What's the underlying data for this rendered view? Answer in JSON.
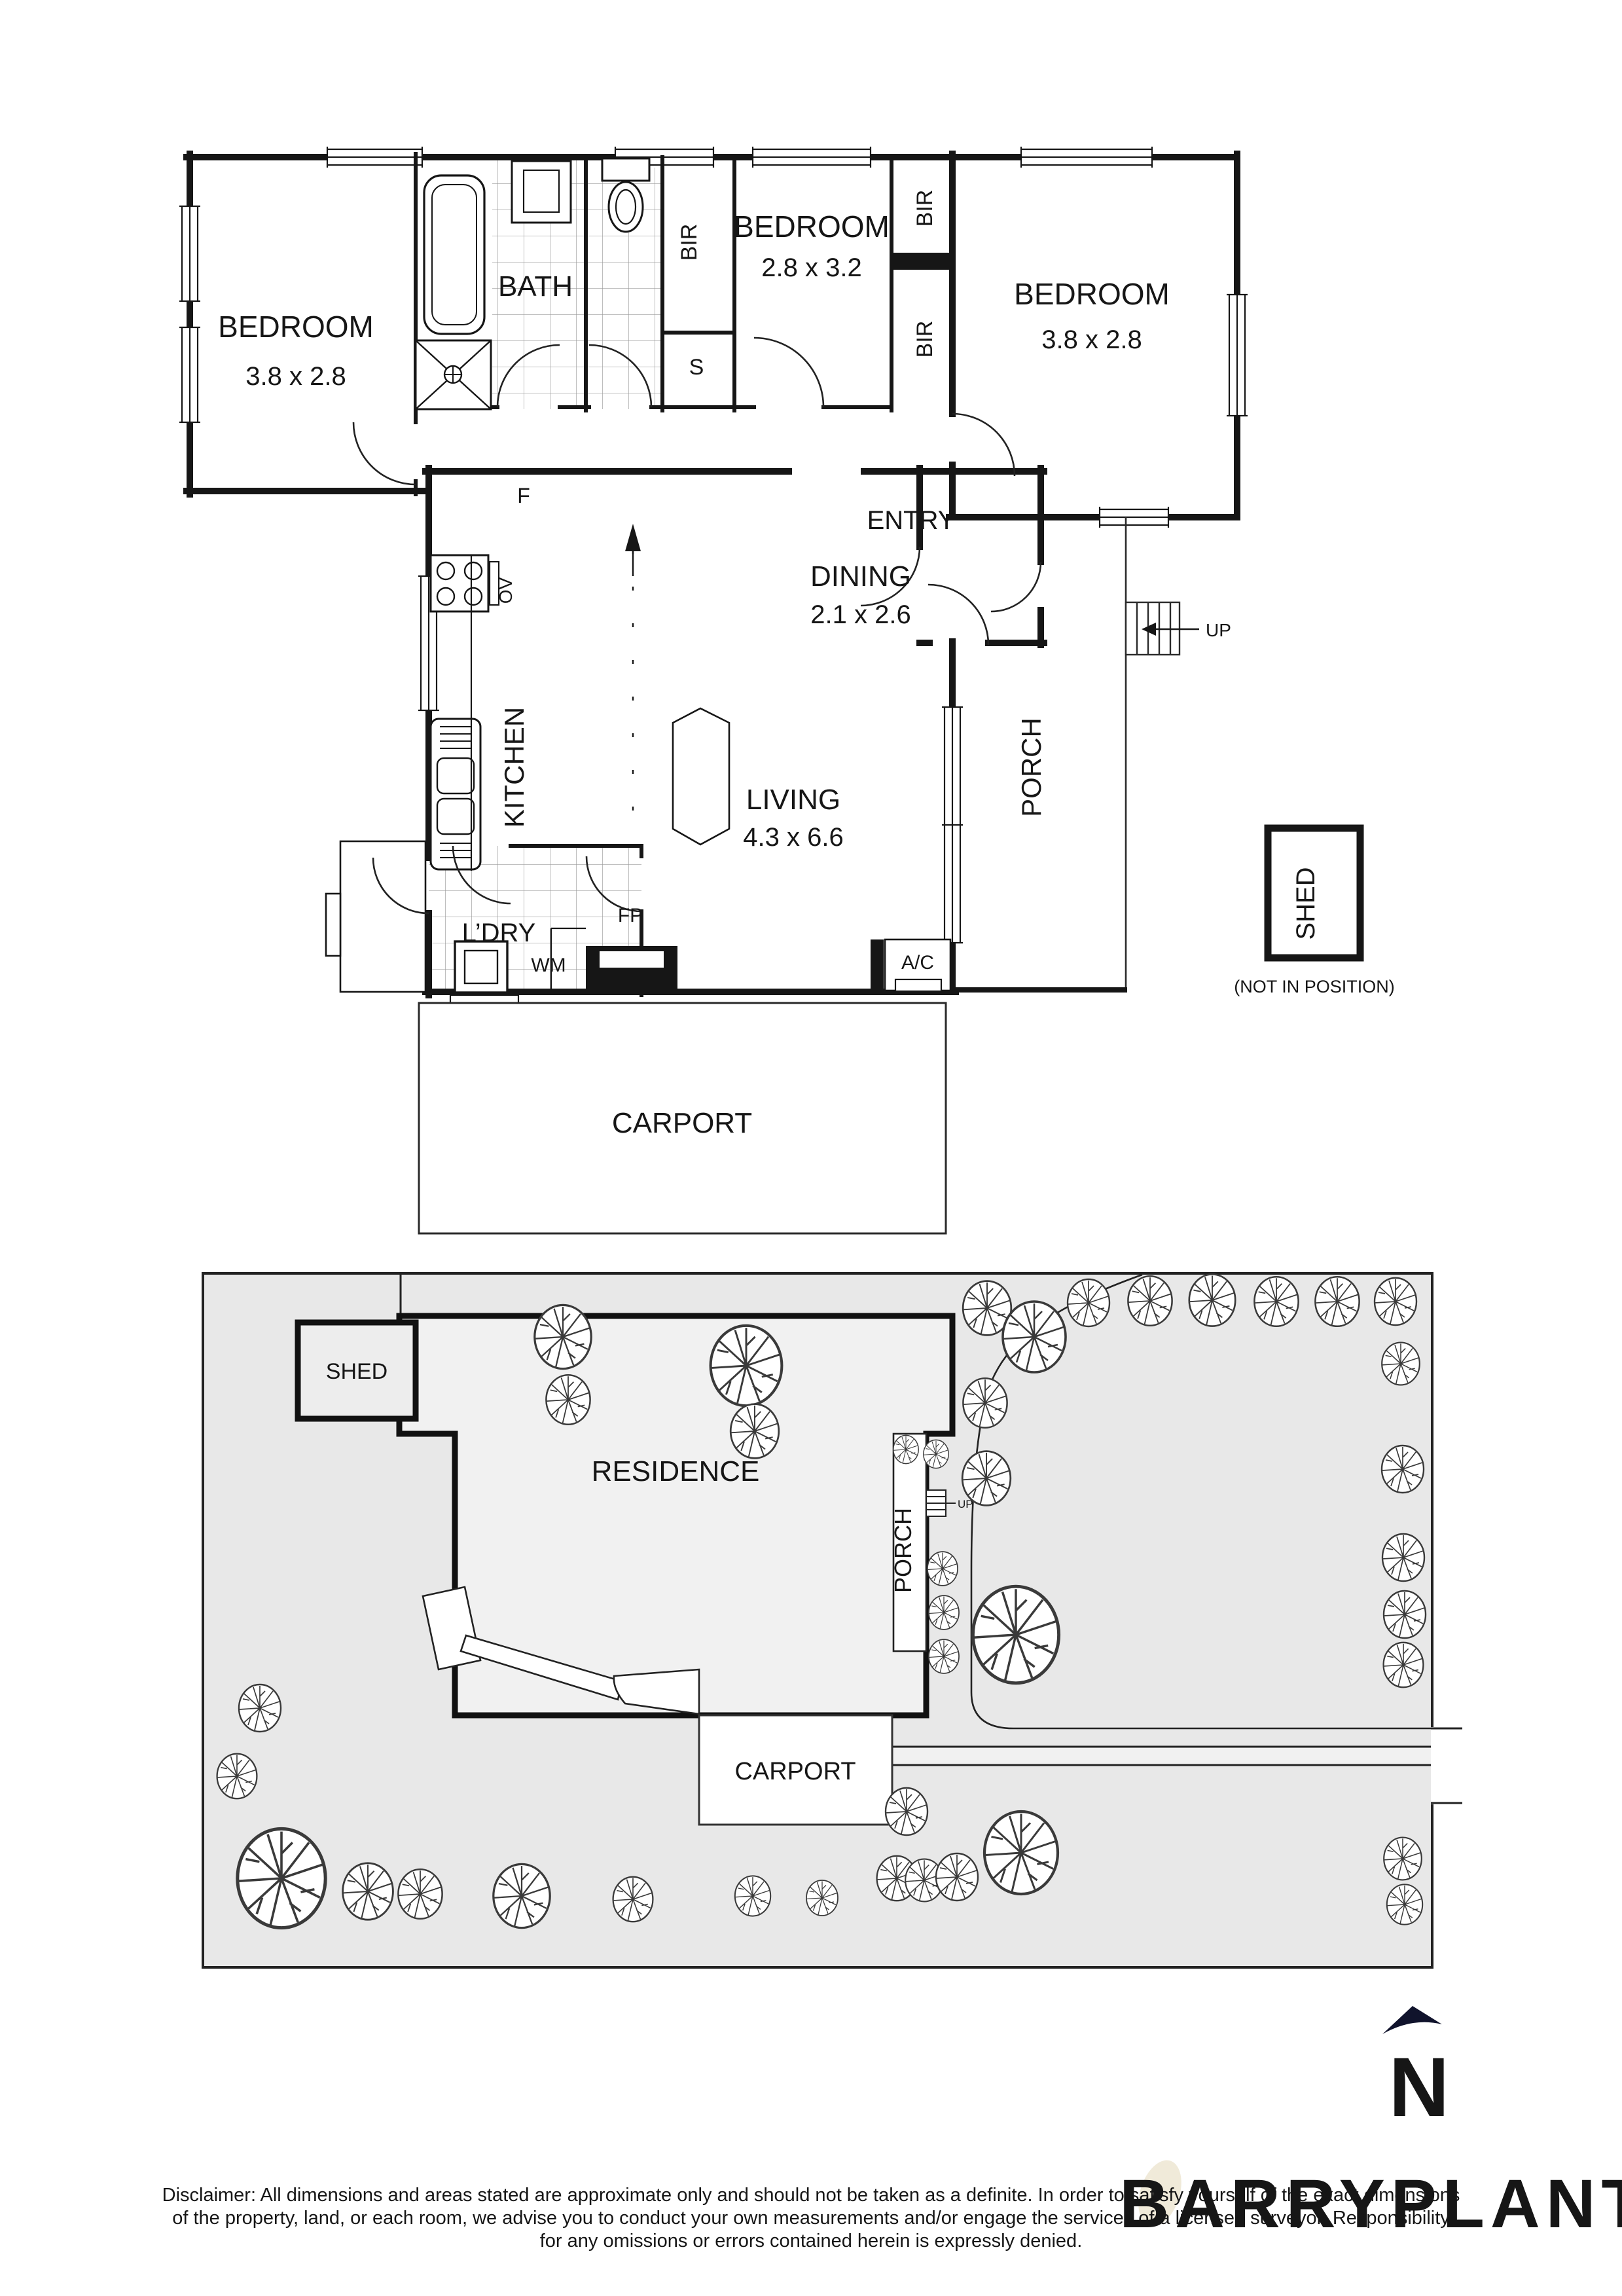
{
  "floor_plan": {
    "bedroom1": {
      "name": "BEDROOM",
      "dims": "3.8 x 2.8"
    },
    "bedroom2": {
      "name": "BEDROOM",
      "dims": "2.8 x 3.2"
    },
    "bedroom3": {
      "name": "BEDROOM",
      "dims": "3.8 x 2.8"
    },
    "bath": "BATH",
    "kitchen": "KITCHEN",
    "dining": {
      "name": "DINING",
      "dims": "2.1 x 2.6"
    },
    "entry": "ENTRY",
    "living": {
      "name": "LIVING",
      "dims": "4.3 x 6.6"
    },
    "laundry": "L’DRY",
    "porch": "PORCH",
    "carport": "CARPORT",
    "shed": "SHED",
    "shed_note": "(NOT IN POSITION)",
    "bir": "BIR",
    "store": "S",
    "fridge": "F",
    "oven": "OV",
    "washer": "WM",
    "fireplace": "FP",
    "aircon": "A/C",
    "up": "UP"
  },
  "site_plan": {
    "residence": "RESIDENCE",
    "porch": "PORCH",
    "carport": "CARPORT",
    "shed": "SHED",
    "up": "UP"
  },
  "compass": {
    "north": "N"
  },
  "watermark": "BARRYPLANT",
  "colors": {
    "wall": "#161616",
    "site_fill": "#e8e8e8",
    "compass": "#10132c",
    "watermark": "#ece6d8"
  },
  "disclaimer": {
    "line1": "Disclaimer: All dimensions and areas stated are approximate only and should not be taken as a definite. In order to satisfy yourself of the exact dimensions",
    "line2": "of the property, land, or each room, we advise you to conduct your own measurements and/or engage the services of a licensed surveyor. Responsibility",
    "line3": "for any omissions or errors contained herein is expressly denied."
  }
}
